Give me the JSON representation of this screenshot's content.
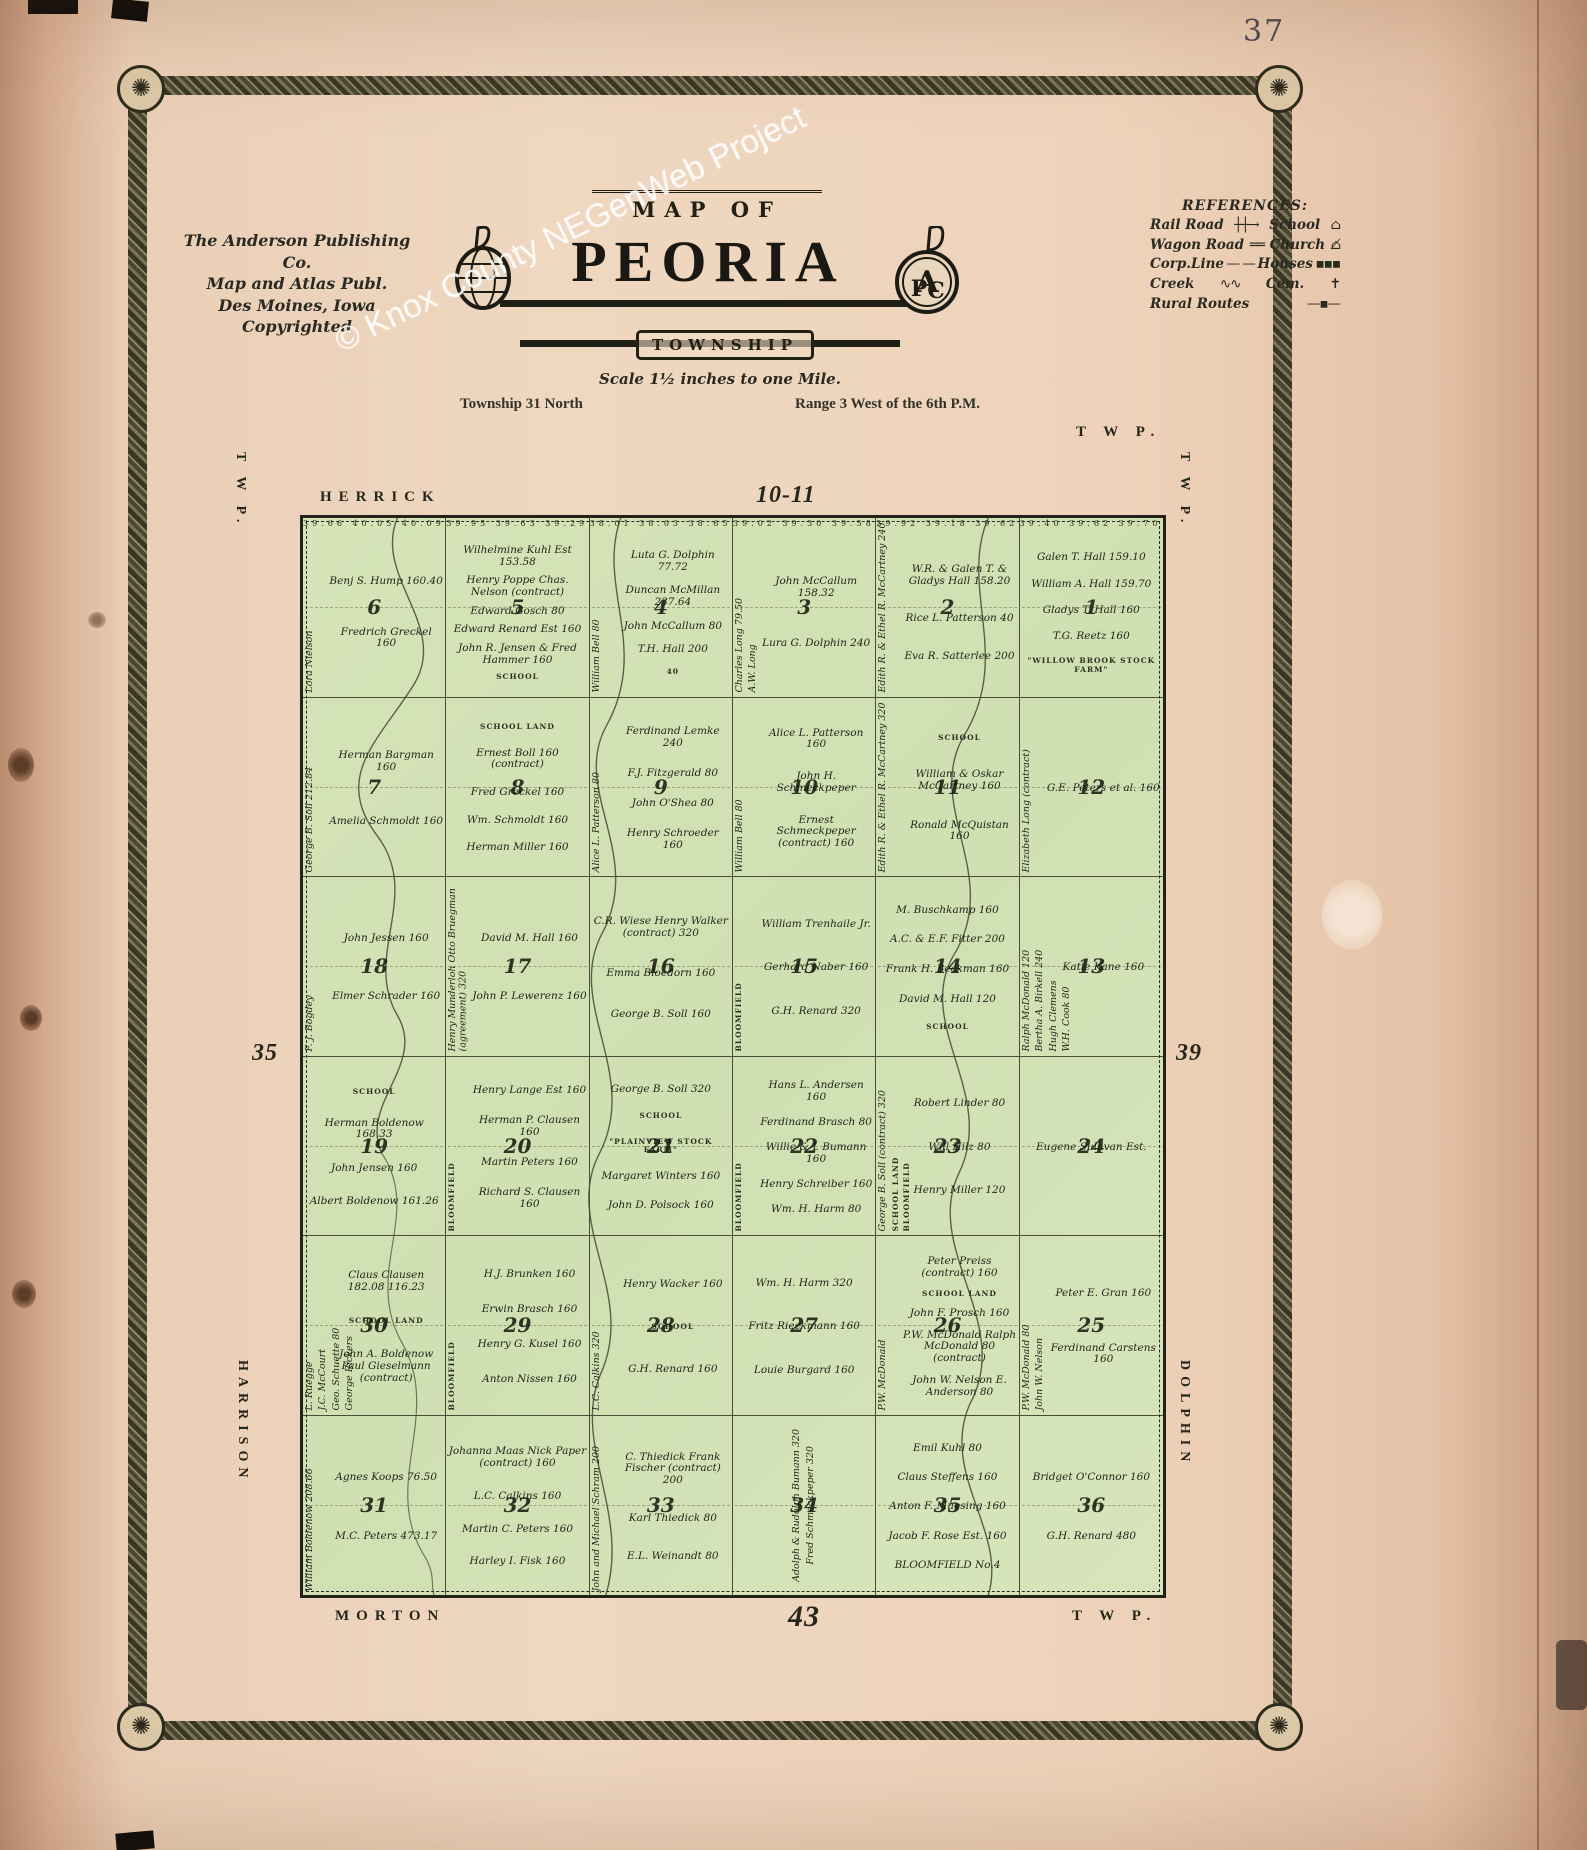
{
  "page": {
    "number": "37",
    "watermark": "© Knox County NEGenWeb Project"
  },
  "publisher": {
    "line1": "The Anderson Publishing Co.",
    "line2": "Map and Atlas Publ.",
    "line3": "Des Moines, Iowa",
    "line4": "Copyrighted"
  },
  "title": {
    "map_of": "MAP OF",
    "name": "PEORIA",
    "township": "TOWNSHIP",
    "scale": "Scale 1½ inches to one Mile.",
    "township_line": "Township 31 North",
    "range_line": "Range 3 West of the 6th P.M."
  },
  "references": {
    "title": "REFERENCES:",
    "left": [
      "Rail Road",
      "Wagon Road",
      "Corp.Line",
      "Creek",
      "Rural Routes"
    ],
    "right": [
      "School",
      "Church",
      "Houses",
      "Cem."
    ]
  },
  "map": {
    "edge_labels": {
      "top_left": "HERRICK",
      "top_center": "10-11",
      "top_right": "T W P.",
      "left_top": "T W P.",
      "right_top": "T W P.",
      "left_mid": "35",
      "right_mid": "39",
      "left_bottom": "HARRISON",
      "right_bottom": "DOLPHIN",
      "bottom_left": "MORTON",
      "bottom_center": "43",
      "bottom_right": "T W P."
    },
    "colors": {
      "land": "#d3e2b5",
      "line": "#2b2b20",
      "paper": "#ecd0b8"
    },
    "sections": [
      {
        "n": 6,
        "nums": "39.66 40.05 40.09 40.11",
        "owners": [
          {
            "t": "Lora Nielson",
            "v": true
          },
          {
            "t": "Benj S. Hump 160.40"
          },
          {
            "t": "Fredrich Greckel 160"
          }
        ]
      },
      {
        "n": 5,
        "nums": "39.95 39.63 39.29 38.97",
        "owners": [
          {
            "t": "Wilhelmine Kuhl Est 153.58"
          },
          {
            "t": "Henry Poppe Chas. Nelson (contract)"
          },
          {
            "t": "Edward Gosch 80"
          },
          {
            "t": "Edward Renard Est 160"
          },
          {
            "t": "John R. Jensen & Fred Hammer 160"
          },
          {
            "t": "SCHOOL"
          }
        ]
      },
      {
        "n": 4,
        "nums": "38.01 38.03 38.65 38.07",
        "owners": [
          {
            "t": "William Bell 80",
            "v": true
          },
          {
            "t": "Luta G. Dolphin 77.72"
          },
          {
            "t": "Duncan McMillan 237.64"
          },
          {
            "t": "John McCallum 80"
          },
          {
            "t": "T.H. Hall 200"
          },
          {
            "t": "40"
          }
        ]
      },
      {
        "n": 3,
        "nums": "39.02 39.30 39.58 39.06",
        "owners": [
          {
            "t": "Charles Long 79.50",
            "v": true
          },
          {
            "t": "A.W. Long",
            "v": true
          },
          {
            "t": "John McCallum 158.32"
          },
          {
            "t": "Lura G. Dolphin 240"
          }
        ]
      },
      {
        "n": 2,
        "nums": "39.92 39.18 39.62 37.40",
        "owners": [
          {
            "t": "Edith R. & Ethel R. McCartney 240",
            "v": true
          },
          {
            "t": "W.R. & Galen T. & Gladys Hall 158.20"
          },
          {
            "t": "Rice L. Patterson 40"
          },
          {
            "t": "Eva R. Satterlee 200"
          }
        ]
      },
      {
        "n": 1,
        "nums": "39.40 39.62 39.70 39.32",
        "owners": [
          {
            "t": "Galen T. Hall 159.10"
          },
          {
            "t": "William A. Hall 159.70"
          },
          {
            "t": "Gladys T. Hall 160"
          },
          {
            "t": "T.G. Reetz 160"
          },
          {
            "t": "\"WILLOW BROOK STOCK FARM\""
          }
        ]
      },
      {
        "n": 7,
        "owners": [
          {
            "t": "George B. Soll 212.84",
            "v": true
          },
          {
            "t": "Herman Bargman 160"
          },
          {
            "t": "Amelia Schmoldt 160"
          }
        ]
      },
      {
        "n": 8,
        "owners": [
          {
            "t": "SCHOOL LAND"
          },
          {
            "t": "Ernest Boll 160 (contract)"
          },
          {
            "t": "Fred Greckel 160"
          },
          {
            "t": "Wm. Schmoldt 160"
          },
          {
            "t": "Herman Miller 160"
          }
        ]
      },
      {
        "n": 9,
        "owners": [
          {
            "t": "Alice L. Patterson 80",
            "v": true
          },
          {
            "t": "Ferdinand Lemke 240"
          },
          {
            "t": "F.J. Fitzgerald 80"
          },
          {
            "t": "John O'Shea 80"
          },
          {
            "t": "Henry Schroeder 160"
          }
        ]
      },
      {
        "n": 10,
        "owners": [
          {
            "t": "William Bell 80",
            "v": true
          },
          {
            "t": "Alice L. Patterson 160"
          },
          {
            "t": "John H. Schmeckpeper"
          },
          {
            "t": "Ernest Schmeckpeper (contract) 160"
          }
        ]
      },
      {
        "n": 11,
        "owners": [
          {
            "t": "Edith R. & Ethel R. McCartney 320",
            "v": true
          },
          {
            "t": "SCHOOL"
          },
          {
            "t": "William & Oskar McCartney 160"
          },
          {
            "t": "Ronald McQuistan 160"
          }
        ]
      },
      {
        "n": 12,
        "owners": [
          {
            "t": "Elizabeth Long (contract)",
            "v": true
          },
          {
            "t": "G.E. Peters et al. 160"
          }
        ]
      },
      {
        "n": 18,
        "owners": [
          {
            "t": "F. J. Bogdey",
            "v": true
          },
          {
            "t": "John Jessen 160"
          },
          {
            "t": "Elmer Schrader 160"
          }
        ]
      },
      {
        "n": 17,
        "owners": [
          {
            "t": "Henry Munderloh Otto Bruegman (agreement) 320",
            "v": true
          },
          {
            "t": "David M. Hall 160"
          },
          {
            "t": "John P. Lewerenz 160"
          }
        ]
      },
      {
        "n": 16,
        "owners": [
          {
            "t": "C.R. Wiese Henry Walker (contract) 320"
          },
          {
            "t": "Emma Bloedorn 160"
          },
          {
            "t": "George B. Soll 160"
          }
        ]
      },
      {
        "n": 15,
        "owners": [
          {
            "t": "BLOOMFIELD",
            "v": true
          },
          {
            "t": "William Trenhaile Jr."
          },
          {
            "t": "Gerhard Naber 160"
          },
          {
            "t": "G.H. Renard 320"
          }
        ]
      },
      {
        "n": 14,
        "owners": [
          {
            "t": "M. Buschkamp 160"
          },
          {
            "t": "A.C. & E.F. Fitter 200"
          },
          {
            "t": "Frank H. Beckman 160"
          },
          {
            "t": "David M. Hall 120"
          },
          {
            "t": "SCHOOL"
          }
        ]
      },
      {
        "n": 13,
        "owners": [
          {
            "t": "Ralph McDonald 120",
            "v": true
          },
          {
            "t": "Bertha A. Birkell 240",
            "v": true
          },
          {
            "t": "Hugh Clemens",
            "v": true
          },
          {
            "t": "W.H. Cook 80",
            "v": true
          },
          {
            "t": "Katie Kane 160"
          }
        ]
      },
      {
        "n": 19,
        "owners": [
          {
            "t": "SCHOOL"
          },
          {
            "t": "Herman Boldenow 168.33"
          },
          {
            "t": "John Jensen 160"
          },
          {
            "t": "Albert Boldenow 161.26"
          }
        ]
      },
      {
        "n": 20,
        "owners": [
          {
            "t": "BLOOMFIELD",
            "v": true
          },
          {
            "t": "Henry Lange Est 160"
          },
          {
            "t": "Herman P. Clausen 160"
          },
          {
            "t": "Martin Peters 160"
          },
          {
            "t": "Richard S. Clausen 160"
          }
        ]
      },
      {
        "n": 21,
        "owners": [
          {
            "t": "George B. Soll 320"
          },
          {
            "t": "SCHOOL"
          },
          {
            "t": "\"PLAINVIEW STOCK FARM\""
          },
          {
            "t": "Margaret Winters 160"
          },
          {
            "t": "John D. Polsock 160"
          }
        ]
      },
      {
        "n": 22,
        "owners": [
          {
            "t": "BLOOMFIELD",
            "v": true
          },
          {
            "t": "Hans L. Andersen 160"
          },
          {
            "t": "Ferdinand Brasch 80"
          },
          {
            "t": "Willie & J. Bumann 160"
          },
          {
            "t": "Henry Schreiber 160"
          },
          {
            "t": "Wm. H. Harm 80"
          }
        ]
      },
      {
        "n": 23,
        "owners": [
          {
            "t": "George B. Soll (contract) 320",
            "v": true
          },
          {
            "t": "SCHOOL LAND",
            "v": true
          },
          {
            "t": "BLOOMFIELD",
            "v": true
          },
          {
            "t": "Robert Linder 80"
          },
          {
            "t": "Will Hilz 80"
          },
          {
            "t": "Henry Miller 120"
          }
        ]
      },
      {
        "n": 24,
        "owners": [
          {
            "t": "Eugene Sullivan Est."
          }
        ]
      },
      {
        "n": 30,
        "owners": [
          {
            "t": "L. Ruegge",
            "v": true
          },
          {
            "t": "J.C. McCourt",
            "v": true
          },
          {
            "t": "Geo. Schuette 80",
            "v": true
          },
          {
            "t": "George Rickers",
            "v": true
          },
          {
            "t": "Claus Clausen 182.08 116.23"
          },
          {
            "t": "SCHOOL LAND"
          },
          {
            "t": "John A. Boldenow Paul Gieselmann (contract)"
          }
        ]
      },
      {
        "n": 29,
        "owners": [
          {
            "t": "BLOOMFIELD",
            "v": true
          },
          {
            "t": "H.J. Brunken 160"
          },
          {
            "t": "Erwin Brasch 160"
          },
          {
            "t": "Henry G. Kusel 160"
          },
          {
            "t": "Anton Nissen 160"
          }
        ]
      },
      {
        "n": 28,
        "owners": [
          {
            "t": "L.C. Calkins 320",
            "v": true
          },
          {
            "t": "Henry Wacker 160"
          },
          {
            "t": "SCHOOL"
          },
          {
            "t": "G.H. Renard 160"
          }
        ]
      },
      {
        "n": 27,
        "owners": [
          {
            "t": "Wm. H. Harm 320"
          },
          {
            "t": "Fritz Rieckmann 160"
          },
          {
            "t": "Louie Burgard 160"
          }
        ]
      },
      {
        "n": 26,
        "owners": [
          {
            "t": "P.W. McDonald",
            "v": true
          },
          {
            "t": "Peter Preiss (contract) 160"
          },
          {
            "t": "SCHOOL LAND"
          },
          {
            "t": "John F. Prosch 160"
          },
          {
            "t": "P.W. McDonald Ralph McDonald 80 (contract)"
          },
          {
            "t": "John W. Nelson E. Anderson 80"
          }
        ]
      },
      {
        "n": 25,
        "owners": [
          {
            "t": "P.W. McDonald 80",
            "v": true
          },
          {
            "t": "John W. Nelson",
            "v": true
          },
          {
            "t": "Peter E. Gran 160"
          },
          {
            "t": "Ferdinand Carstens 160"
          }
        ]
      },
      {
        "n": 31,
        "owners": [
          {
            "t": "William Boldenow 208.66",
            "v": true
          },
          {
            "t": "Agnes Koops 76.50"
          },
          {
            "t": "M.C. Peters 473.17"
          }
        ]
      },
      {
        "n": 32,
        "owners": [
          {
            "t": "Johanna Maas Nick Paper (contract) 160"
          },
          {
            "t": "L.C. Calkins 160"
          },
          {
            "t": "Martin C. Peters 160"
          },
          {
            "t": "Harley I. Fisk 160"
          }
        ]
      },
      {
        "n": 33,
        "owners": [
          {
            "t": "John and Michael Schram 200",
            "v": true
          },
          {
            "t": "C. Thiedick Frank Fischer (contract) 200"
          },
          {
            "t": "Karl Thiedick 80"
          },
          {
            "t": "E.L. Weinandt 80"
          }
        ]
      },
      {
        "n": 34,
        "owners": [
          {
            "t": "Adolph & Rudolph Bumann 320",
            "v": true
          },
          {
            "t": "Fred Schmeckpeper 320",
            "v": true
          }
        ]
      },
      {
        "n": 35,
        "owners": [
          {
            "t": "Emil Kuhl 80"
          },
          {
            "t": "Claus Steffens 160"
          },
          {
            "t": "Anton F. Muesing 160"
          },
          {
            "t": "Jacob F. Rose Est. 160"
          },
          {
            "t": "BLOOMFIELD No.4"
          }
        ]
      },
      {
        "n": 36,
        "owners": [
          {
            "t": "Bridget O'Connor 160"
          },
          {
            "t": "G.H. Renard 480"
          }
        ]
      }
    ]
  }
}
